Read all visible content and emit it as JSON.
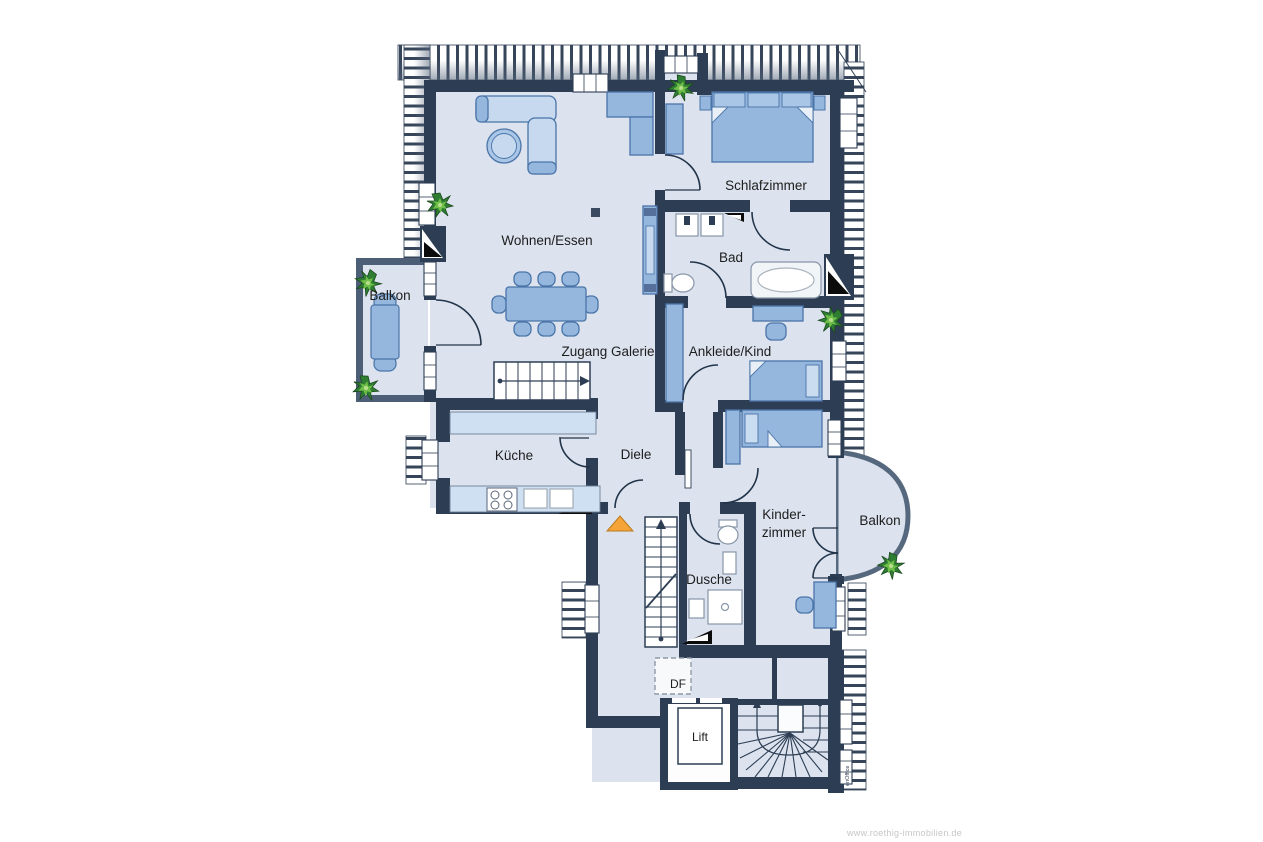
{
  "plan": {
    "type": "floor-plan",
    "rooms": {
      "wohnen_essen": "Wohnen/Essen",
      "schlafzimmer": "Schlafzimmer",
      "bad": "Bad",
      "balkon_links": "Balkon",
      "zugang_galerie": "Zugang Galerie",
      "ankleide_kind": "Ankleide/Kind",
      "kueche": "Küche",
      "diele": "Diele",
      "kinderzimmer_line1": "Kinder-",
      "kinderzimmer_line2": "zimmer",
      "balkon_rechts": "Balkon",
      "dusche": "Dusche",
      "dachfenster": "DF",
      "lift": "Lift"
    }
  },
  "branding": {
    "watermark": "www.roethig-immobilien.de",
    "software_logo": "enOffice"
  },
  "colors": {
    "wall": "#2d3e54",
    "floor": "#dce3ee",
    "furniture": "#95b7de",
    "furniture_light": "#c6d9ee",
    "counter": "#cfe0f2",
    "plant_green": "#2f7d33",
    "accent_orange": "#f5a43a",
    "watermark_gray": "#c6c6c6"
  }
}
